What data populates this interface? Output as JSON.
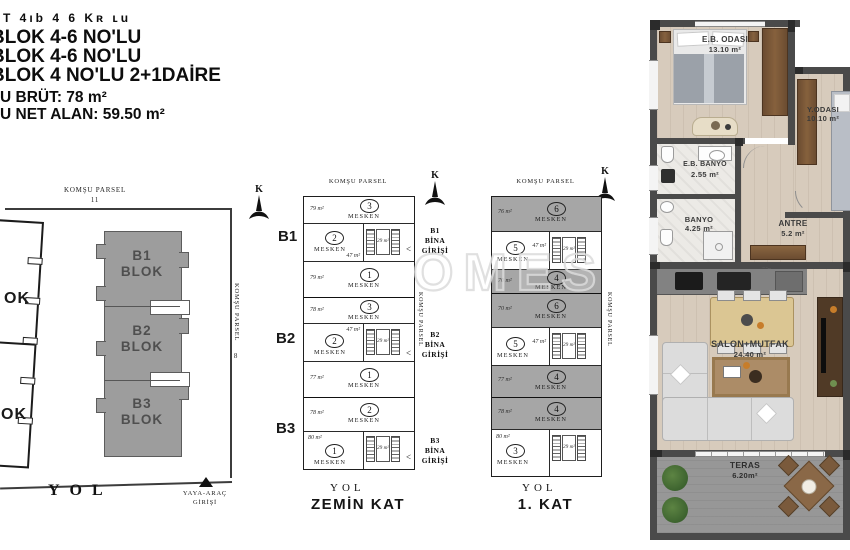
{
  "header": {
    "scribble": "T 4ıb 4 6 Kʀ ʟu",
    "line1": "BLOK 4-6 NO'LU",
    "line2": "BLOK 4-6 NO'LU",
    "line3": "BLOK 4 NO'LU 2+1DAİRE",
    "brut": "U BRÜT: 78 m²",
    "net": "U NET ALAN: 59.50 m²"
  },
  "watermark": "OMES",
  "north_label": "K",
  "site": {
    "parcel_top": "KOMŞU PARSEL",
    "parcel_top_no": "11",
    "parcel_right": "KOMŞU PARSEL",
    "parcel_right_no": "8",
    "neighbor_label_1": "OK",
    "neighbor_label_2": "OK",
    "road": "YOL",
    "entrance_line1": "YAYA-ARAÇ",
    "entrance_line2": "GİRİŞİ",
    "blocks": [
      {
        "line1": "B1",
        "line2": "BLOK"
      },
      {
        "line1": "B2",
        "line2": "BLOK"
      },
      {
        "line1": "B3",
        "line2": "BLOK"
      }
    ]
  },
  "zemin": {
    "title": "ZEMİN KAT",
    "road": "YOL",
    "parcel_top": "KOMŞU PARSEL",
    "parcel_right": "KOMŞU PARSEL",
    "b1": "B1",
    "b2": "B2",
    "b3": "B3",
    "stair_area": "29 m²",
    "entry_arrow": "<",
    "entries": [
      {
        "l1": "B1",
        "l2": "BİNA",
        "l3": "GİRİŞİ"
      },
      {
        "l1": "B2",
        "l2": "BİNA",
        "l3": "GİRİŞİ"
      },
      {
        "l1": "B3",
        "l2": "BİNA",
        "l3": "GİRİŞİ"
      }
    ],
    "units": [
      {
        "no": "3",
        "label": "MESKEN",
        "area": "79 m²"
      },
      {
        "no": "2",
        "label": "MESKEN",
        "area": "47 m²"
      },
      {
        "no": "1",
        "label": "MESKEN",
        "area": "79 m²"
      },
      {
        "no": "3",
        "label": "MESKEN",
        "area": "78 m²"
      },
      {
        "no": "2",
        "label": "MESKEN",
        "area": "47 m²"
      },
      {
        "no": "1",
        "label": "MESKEN",
        "area": "77 m²"
      },
      {
        "no": "2",
        "label": "MESKEN",
        "area": "78 m²"
      },
      {
        "no": "1",
        "label": "MESKEN",
        "area": "80 m²"
      }
    ]
  },
  "kat1": {
    "title": "1. KAT",
    "road": "YOL",
    "parcel_top": "KOMŞU PARSEL",
    "parcel_right": "KOMŞU PARSEL",
    "stair_area": "29 m²",
    "units": [
      {
        "no": "6",
        "label": "MESKEN",
        "area": "76 m²"
      },
      {
        "no": "5",
        "label": "MESKEN",
        "area": "47 m²"
      },
      {
        "no": "4",
        "label": "MESKEN",
        "area": "70 m²"
      },
      {
        "no": "6",
        "label": "MESKEN",
        "area": "70 m²"
      },
      {
        "no": "5",
        "label": "MESKEN",
        "area": "47 m²"
      },
      {
        "no": "4",
        "label": "MESKEN",
        "area": "77 m²"
      },
      {
        "no": "4",
        "label": "MESKEN",
        "area": "78 m²"
      },
      {
        "no": "3",
        "label": "MESKEN",
        "area": "80 m²"
      }
    ]
  },
  "apartment": {
    "rooms": {
      "eb_odasi": {
        "name": "E.B. ODASI",
        "area": "13.10 m²"
      },
      "y_odasi": {
        "name": "Y.ODASI",
        "area": "10.10 m²"
      },
      "eb_banyo": {
        "name": "E.B. BANYO",
        "area": "2.55 m²"
      },
      "banyo": {
        "name": "BANYO",
        "area": "4.25 m²"
      },
      "antre": {
        "name": "ANTRE",
        "area": "5.2 m²"
      },
      "salon": {
        "name": "SALON+MUTFAK",
        "area": "24.40 m²"
      },
      "teras": {
        "name": "TERAS",
        "area": "6.20m²"
      }
    }
  },
  "colors": {
    "block_gray": "#a6a6a6",
    "wall": "#4a4a4a",
    "wood_floor": "#d7cbbc",
    "wood_furniture": "#6d4e33"
  }
}
